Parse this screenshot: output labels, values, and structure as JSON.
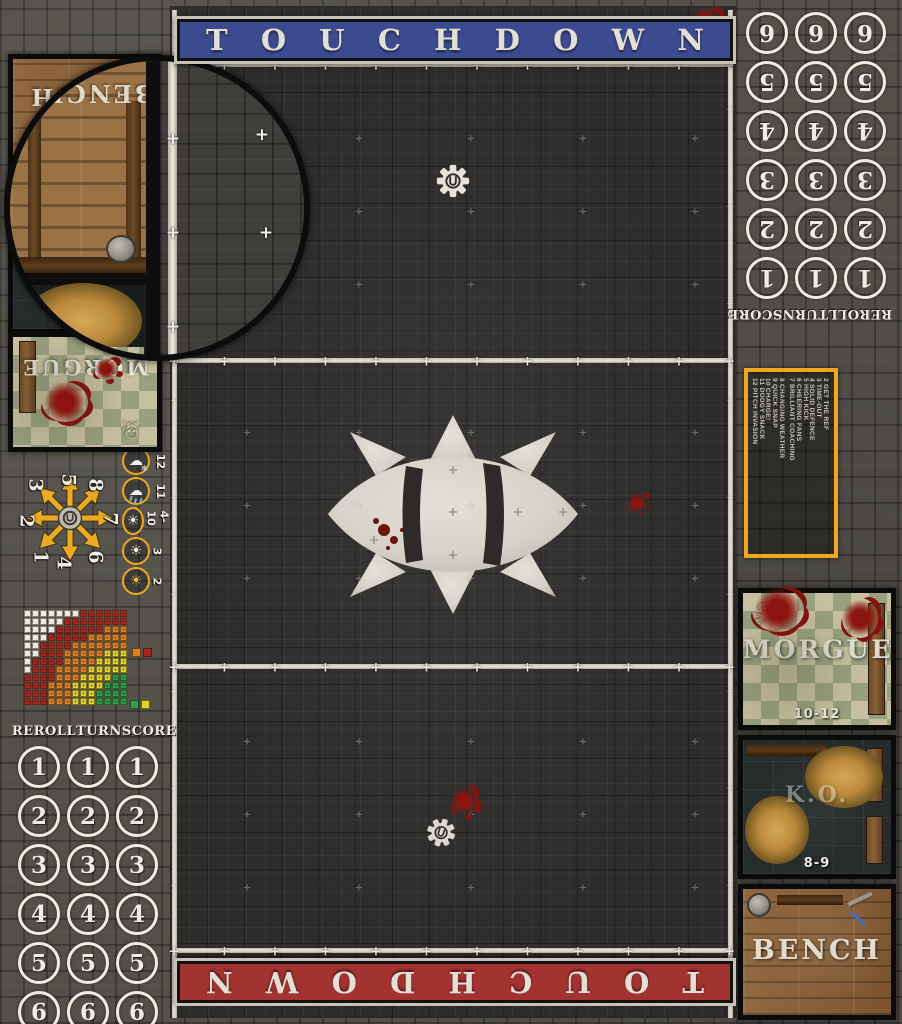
{
  "banners": {
    "top": {
      "label": "TOUCHDOWN",
      "color": "#3c4b8f"
    },
    "bottom": {
      "label": "TOUCHDOWN",
      "color": "#a33330"
    }
  },
  "turn_tracks": {
    "columns": [
      "REROLL",
      "TURN",
      "SCORE"
    ],
    "rows": [
      "1",
      "2",
      "3",
      "4",
      "5",
      "6"
    ]
  },
  "kickoff_table": {
    "border_color": "#eda920",
    "column1": [
      "2 GET THE REF",
      "3 TIME-OUT",
      "4 SOLID DEFENCE",
      "5 HIGH KICK",
      "6 CHEERING FANS",
      "7 BRILLIANT COACHING"
    ],
    "column2": [
      "8 CHANGING WEATHER",
      "9 QUICK SNAP",
      "10 CHARGE!",
      "11 DODGY SNACK",
      "12 PITCH INVASION"
    ]
  },
  "weather_track": {
    "ring_color": "#eda920",
    "entries": [
      {
        "value": "12",
        "icon": "snow-cloud-icon"
      },
      {
        "value": "11",
        "icon": "rain-cloud-icon"
      },
      {
        "value": "4-10",
        "icon": "sun-icon"
      },
      {
        "value": "3",
        "icon": "sun-bright-icon"
      },
      {
        "value": "2",
        "icon": "sun-blazing-icon"
      }
    ]
  },
  "scatter_template": {
    "arrow_color": "#eda920",
    "numbers": [
      {
        "value": "1",
        "x": 18,
        "y": 80
      },
      {
        "value": "2",
        "x": 4,
        "y": 44
      },
      {
        "value": "3",
        "x": 13,
        "y": 8
      },
      {
        "value": "4",
        "x": 41,
        "y": 86
      },
      {
        "value": "5",
        "x": 46,
        "y": 3
      },
      {
        "value": "6",
        "x": 73,
        "y": 80
      },
      {
        "value": "7",
        "x": 88,
        "y": 42
      },
      {
        "value": "8",
        "x": 73,
        "y": 8
      }
    ]
  },
  "range_ruler": {
    "cols": 13,
    "rows": 12,
    "bands": [
      {
        "name": "quick-pass",
        "color": "#2f9e44",
        "max": 3.4
      },
      {
        "name": "short-pass",
        "color": "#e3d22c",
        "max": 6.4
      },
      {
        "name": "long-pass",
        "color": "#e07f24",
        "max": 9.4
      },
      {
        "name": "long-bomb",
        "color": "#a8251c",
        "max": 12.4
      },
      {
        "name": "out-of-range",
        "color": "#eceadf",
        "max": 99
      }
    ],
    "legend_rows": [
      [
        "#e07f24",
        "#a8251c"
      ],
      [
        "#2f9e44",
        "#e3d22c"
      ]
    ]
  },
  "dugouts": {
    "right": {
      "morgue": {
        "label": "MORGUE",
        "range": "10-12"
      },
      "ko": {
        "label": "K.O.",
        "range": "8-9"
      },
      "bench": {
        "label": "BENCH"
      }
    },
    "left": {
      "bench": {
        "label": "BENCH"
      },
      "ko": {
        "range": "8-9"
      },
      "morgue": {
        "label": "MORGUE"
      }
    }
  },
  "icons": {
    "skeleton": "☠",
    "sun": "☀",
    "cloud": "☁",
    "snowflake": "❄"
  }
}
